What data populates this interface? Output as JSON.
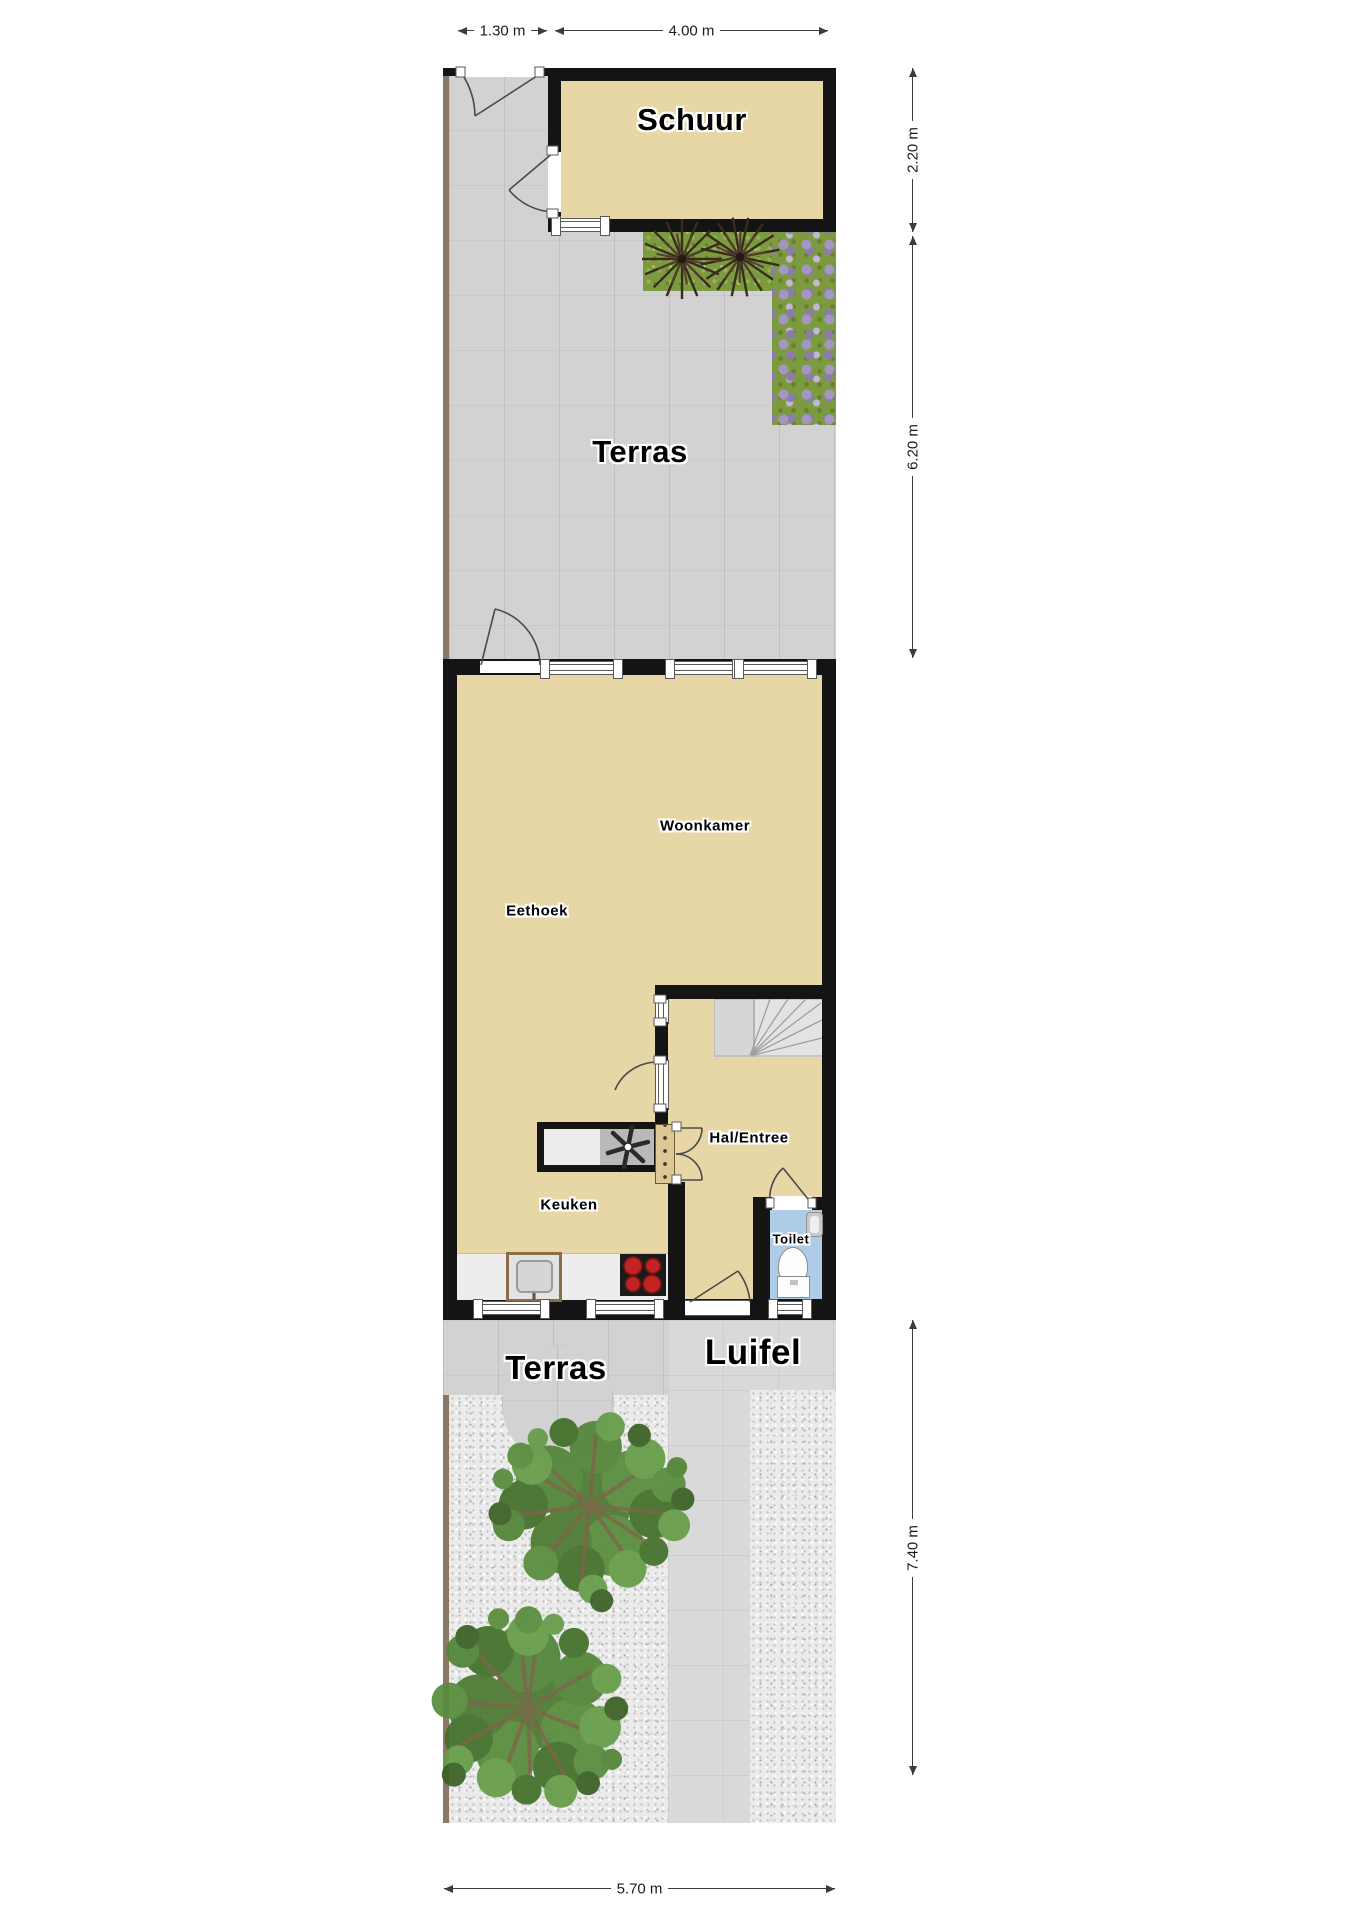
{
  "title": "Begane grond plattegrond met tuin",
  "labels": {
    "schuur": "Schuur",
    "terras_upper": "Terras",
    "woonkamer": "Woonkamer",
    "eethoek": "Eethoek",
    "hal_entree": "Hal/Entree",
    "keuken": "Keuken",
    "toilet": "Toilet",
    "terras_lower": "Terras",
    "luifel": "Luifel"
  },
  "dimensions": {
    "top_small": "1.30 m",
    "top_large": "4.00 m",
    "right_upper": "2.20 m",
    "right_middle": "6.20 m",
    "right_lower": "7.40 m",
    "bottom": "5.70 m"
  },
  "colors": {
    "room_fill": "#e7d6a6",
    "wall": "#141414",
    "tile_gray": "#d2d2d2",
    "luifel_gray": "#d9d9d9",
    "gravel": "#ebebeb",
    "grass_green": "#7c9b3f",
    "flower_purple": "#a496c2",
    "toilet_floor_blue": "#aecce8",
    "hob_burner_red": "#c22424",
    "fence_brown": "#8a7866",
    "tree_green": "#4b7a31"
  },
  "icons": [
    "tree-icon",
    "spiky-plant-icon",
    "flower-bed",
    "door-swing-icon",
    "stairs-icon",
    "fan-symbol-icon",
    "sink-icon",
    "hob-icon",
    "toilet-icon",
    "wc-sink-icon",
    "dimension-arrow"
  ]
}
